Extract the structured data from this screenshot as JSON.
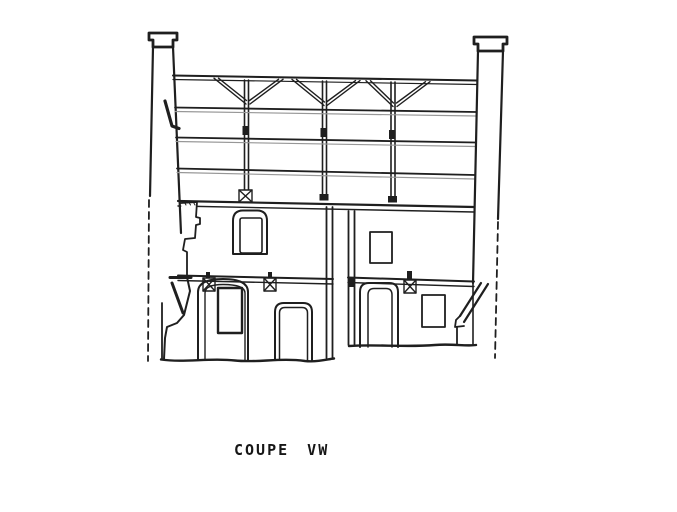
{
  "canvas": {
    "width": 677,
    "height": 512,
    "background": "#ffffff"
  },
  "palette": {
    "ink": "#1f1f1f",
    "ink_light": "#979797",
    "paper": "#ffffff"
  },
  "caption": {
    "text": "COUPE VW"
  },
  "drawing": {
    "kind": "architectural-cross-section",
    "elements": [
      {
        "name": "left-chimney",
        "label": "left masonry pier with capital, section cut shown dashed below"
      },
      {
        "name": "right-chimney",
        "label": "right masonry pier with capital, section cut shown dashed below"
      },
      {
        "name": "roof-truss",
        "label": "top chord with three vertical posts and paired diagonal braces"
      },
      {
        "name": "floor-beams",
        "label": "three intermediate horizontal beam levels spanning between piers"
      },
      {
        "name": "wall-plate",
        "label": "double line at top of masonry storey"
      },
      {
        "name": "column-bases",
        "label": "X-marked post bases and black bearing pads"
      },
      {
        "name": "left-room",
        "label": "left dwelling: arched window above, arched niche with recess and rounded door below"
      },
      {
        "name": "right-room",
        "label": "right dwelling: rectangular window above, rounded door, window and sloped coping below"
      },
      {
        "name": "party-walls",
        "label": "two parallel separating walls between the rooms"
      },
      {
        "name": "ground-lines",
        "label": "wavy ground lines at two levels"
      }
    ]
  }
}
